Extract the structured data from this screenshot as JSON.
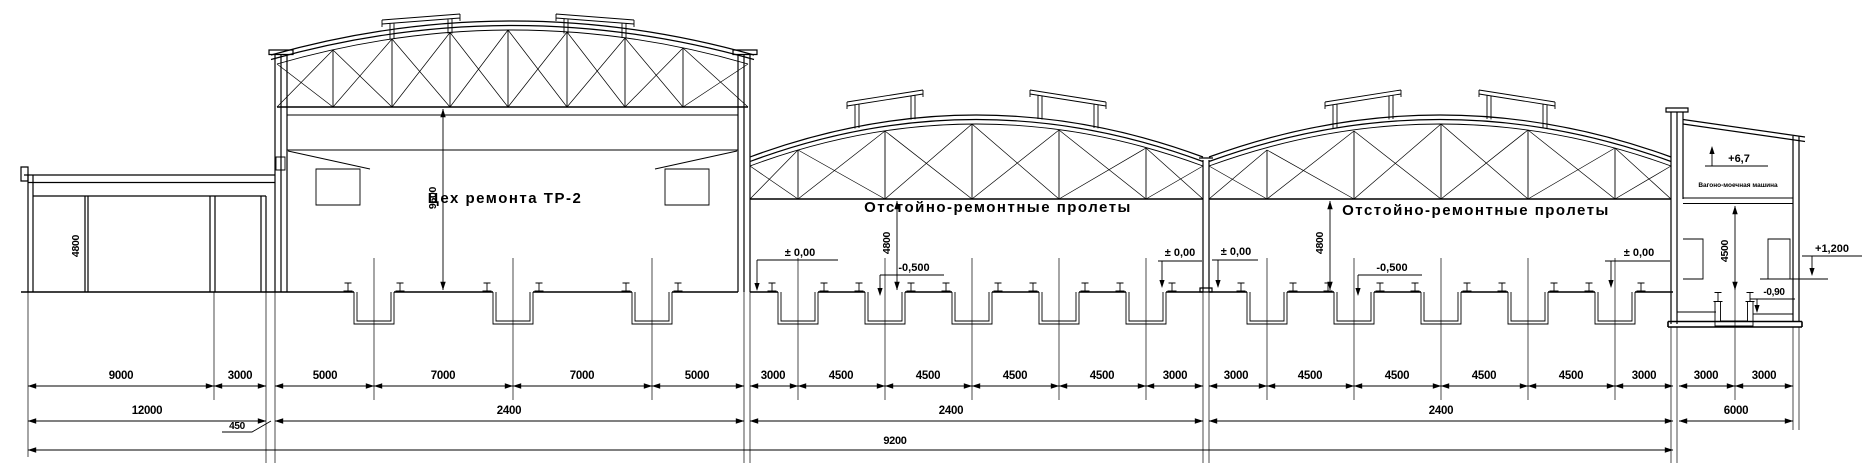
{
  "drawing": {
    "background": "#ffffff",
    "line_color": "#000000",
    "sections": {
      "annex": {
        "height_label": "4800"
      },
      "repair_hall": {
        "title": "Цех ремонта ТР-2",
        "height_label": "9600"
      },
      "span1": {
        "title": "Отстойно-ремонтные пролеты",
        "height_label": "4800"
      },
      "span2": {
        "title": "Отстойно-ремонтные пролеты",
        "height_label": "4800"
      },
      "washer_bay": {
        "title": "Вагоно-моечная машина",
        "height_label": "4500"
      }
    },
    "elevation_marks": {
      "zero_span1_left": "± 0,00",
      "zero_valley_left": "± 0,00",
      "zero_valley_right": "± 0,00",
      "zero_span2_right": "± 0,00",
      "minus_0500_span1": "-0,500",
      "minus_0500_span2": "-0,500",
      "plus_67_roof": "+6,7",
      "plus_1200_platform": "+1,200",
      "minus_090_pit": "-0,90"
    },
    "dimensions": {
      "row1": [
        "9000",
        "3000",
        "5000",
        "7000",
        "7000",
        "5000",
        "3000",
        "4500",
        "4500",
        "4500",
        "4500",
        "3000",
        "3000",
        "4500",
        "4500",
        "4500",
        "4500",
        "3000",
        "3000",
        "3000"
      ],
      "row2": [
        "12000",
        "2400",
        "2400",
        "2400",
        "6000"
      ],
      "offset_450": "450",
      "row3_total": "9200"
    }
  }
}
